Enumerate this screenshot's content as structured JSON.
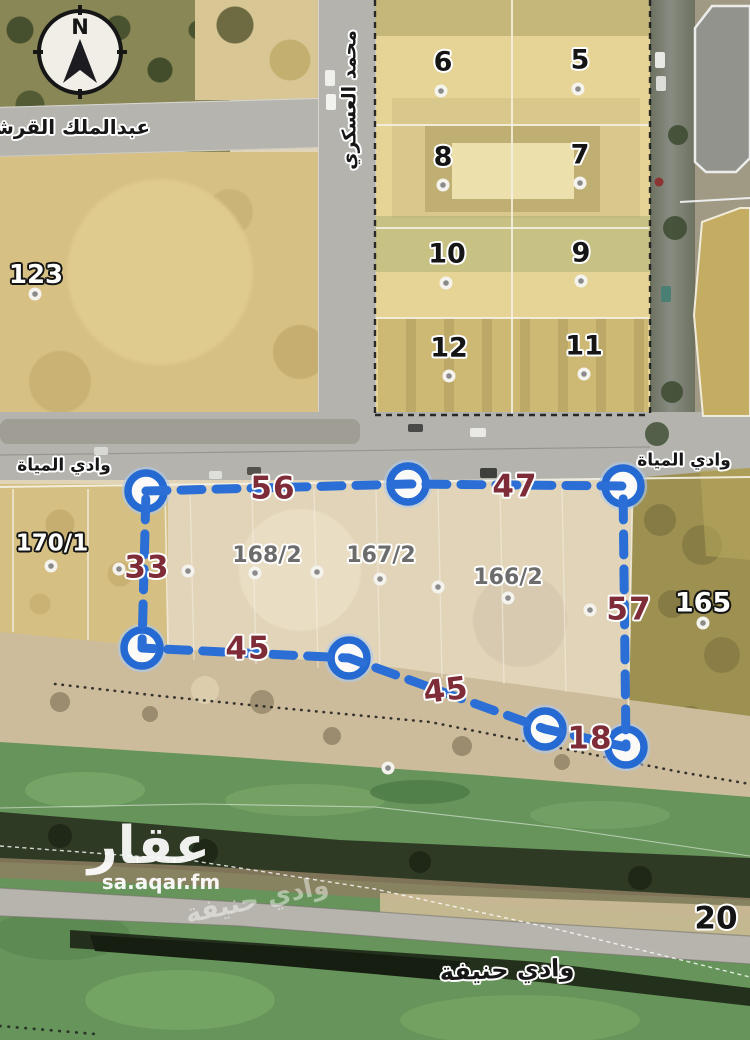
{
  "map": {
    "compass": {
      "north": "N"
    },
    "streets": {
      "abdulmalik_alqurashi": "عبدالملك القرشي",
      "mohammed_alaskari": "محمد العسكري",
      "wadi_almiyah": "وادي المياة",
      "wadi_hanifa": "وادي حنيفة"
    },
    "watermark": {
      "brand": "عقار",
      "site": "sa.aqar.fm",
      "overlay": "وادي حنيفة"
    },
    "blocks": {
      "b5": "5",
      "b6": "6",
      "b7": "7",
      "b8": "8",
      "b9": "9",
      "b10": "10",
      "b11": "11",
      "b12": "12"
    },
    "parcels": {
      "p123": "123",
      "p170_1": "170/1",
      "p168_2": "168/2",
      "p167_2": "167/2",
      "p166_2": "166/2",
      "p165": "165",
      "p20": "20"
    },
    "dimensions": {
      "top_left": "56",
      "top_right": "47",
      "left": "33",
      "right": "57",
      "bottom_left": "45",
      "bottom_mid": "45",
      "bottom_right": "18"
    },
    "colors": {
      "boundary_blue": "#2b6fd6",
      "dimension_red": "#7e2d38",
      "sand": "#d7c083",
      "parcel_tan": "#e6d496",
      "wadi_green": "#67945a"
    }
  }
}
